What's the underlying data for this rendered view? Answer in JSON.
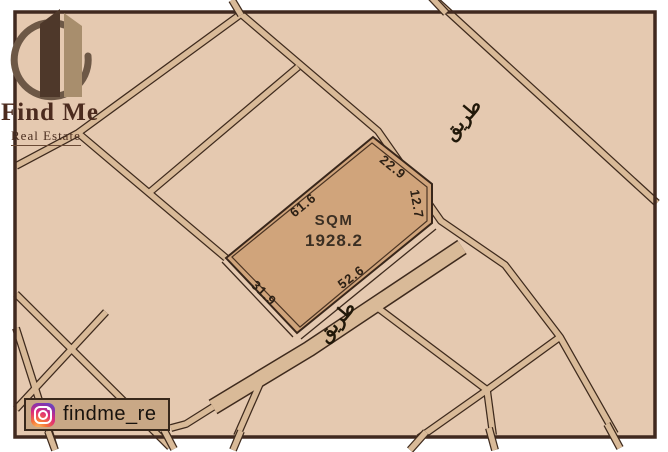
{
  "brand": {
    "title": "Find Me",
    "subtitle": "Real Estate"
  },
  "social": {
    "handle": "findme_re"
  },
  "plot": {
    "area_label": "SQM",
    "area_value": "1928.2",
    "dimensions": [
      {
        "edge": "northwest",
        "value": "61.6"
      },
      {
        "edge": "northeast",
        "value": "22.9"
      },
      {
        "edge": "east-corner-cut",
        "value": "12.7"
      },
      {
        "edge": "southeast",
        "value": "52.6"
      },
      {
        "edge": "southwest",
        "value": "31.9"
      }
    ]
  },
  "roads": {
    "labels": [
      {
        "text": "طريق",
        "position": "upper-right"
      },
      {
        "text": "طريق",
        "position": "below-plot"
      }
    ]
  },
  "colors": {
    "page_background": "#ffffff",
    "map_background": "#e5c9b0",
    "road_fill": "#d9ba98",
    "line": "#3e2a1d",
    "plot_fill": "#d0a47b"
  }
}
